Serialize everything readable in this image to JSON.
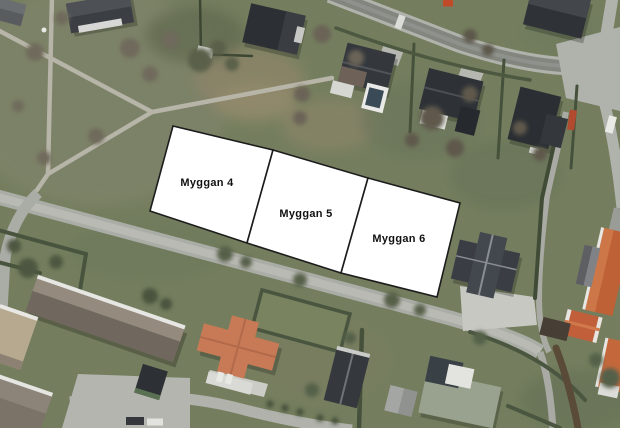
{
  "map": {
    "parcels": [
      {
        "id": "myggan-4",
        "label": "Myggan 4"
      },
      {
        "id": "myggan-5",
        "label": "Myggan 5"
      },
      {
        "id": "myggan-6",
        "label": "Myggan 6"
      }
    ],
    "overlay": {
      "fill": "#ffffff",
      "stroke": "#1c1c1c",
      "label_color": "#111111"
    },
    "palette": {
      "grass": "#747e5e",
      "road_light": "#aaaca6",
      "asphalt_dark": "#83867f",
      "path_tan": "#b7b5a8",
      "hedge_green": "#46513b",
      "roof_dark": "#33373c",
      "roof_brown": "#8b8176",
      "roof_orange": "#c06a45"
    }
  }
}
